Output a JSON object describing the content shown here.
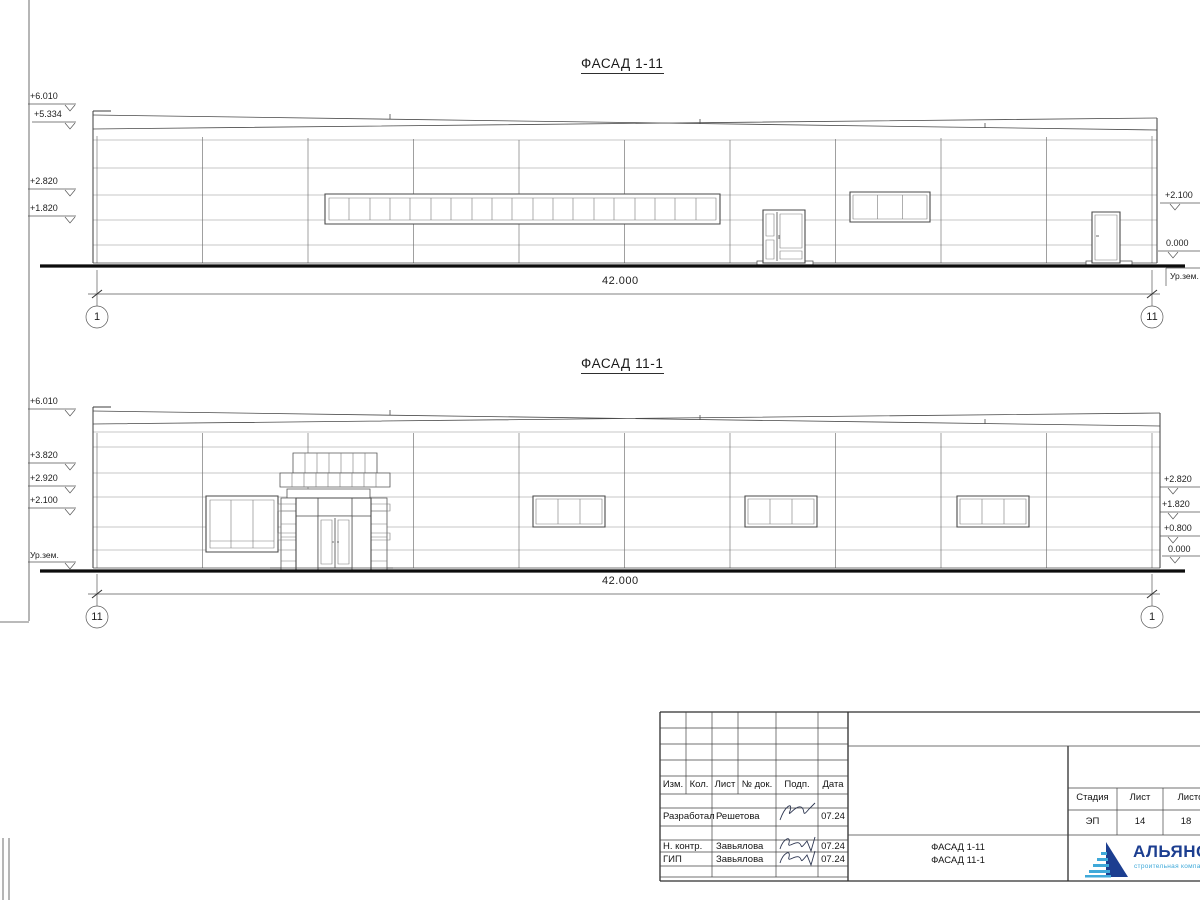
{
  "facade_top": {
    "title": "ФАСАД 1-11",
    "marks_left": [
      "+6.010",
      "+5.334",
      "+2.820",
      "+1.820"
    ],
    "marks_right": [
      "+2.100",
      "0.000"
    ],
    "ground_label_right": "Ур.зем.",
    "dimension": "42.000",
    "axis_left": "1",
    "axis_right": "11"
  },
  "facade_bottom": {
    "title": "ФАСАД 11-1",
    "marks_left": [
      "+6.010",
      "+3.820",
      "+2.920",
      "+2.100"
    ],
    "ground_label_left": "Ур.зем.",
    "marks_right": [
      "+2.820",
      "+1.820",
      "+0.800",
      "0.000"
    ],
    "dimension": "42.000",
    "axis_left": "11",
    "axis_right": "1"
  },
  "title_block": {
    "columns": [
      "Изм.",
      "Кол.",
      "Лист",
      "№ док.",
      "Подп.",
      "Дата"
    ],
    "rows": [
      {
        "role": "Разработал",
        "name": "Решетова",
        "date": "07.24"
      },
      {
        "role": "Н. контр.",
        "name": "Завьялова",
        "date": "07.24"
      },
      {
        "role": "ГИП",
        "name": "Завьялова",
        "date": "07.24"
      }
    ],
    "doc_title_line1": "ФАСАД 1-11",
    "doc_title_line2": "ФАСАД 11-1",
    "stage_header": "Стадия",
    "sheet_header": "Лист",
    "sheets_header": "Листов",
    "stage_value": "ЭП",
    "sheet_value": "14",
    "sheets_value": "18"
  },
  "logo": {
    "name": "АЛЬЯНС",
    "subtitle": "строительная компания",
    "primary_color": "#1c3e90",
    "accent_color": "#3fa9d9"
  }
}
